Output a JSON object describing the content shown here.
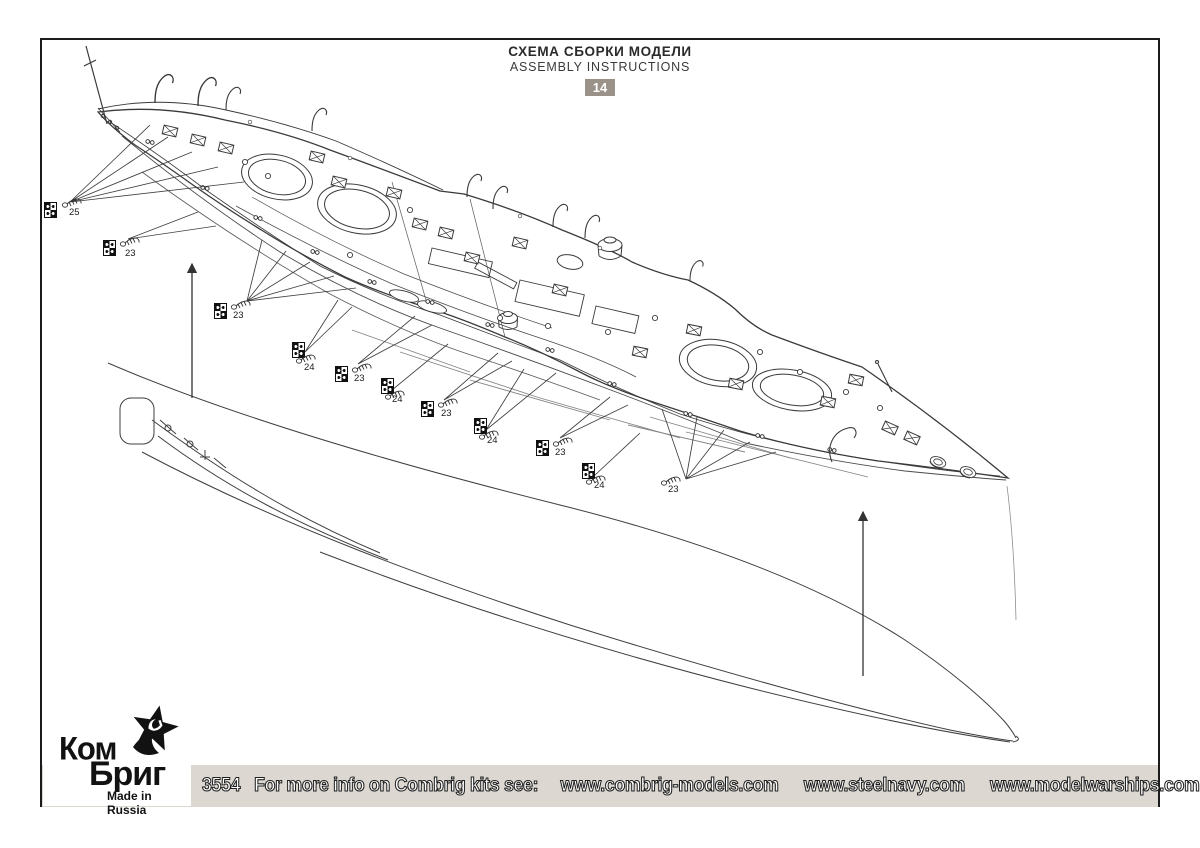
{
  "header": {
    "title_ru": "СХЕМА СБОРКИ МОДЕЛИ",
    "title_en": "ASSEMBLY INSTRUCTIONS",
    "sheet_number": "14"
  },
  "callouts": [
    {
      "label": "25",
      "marker": {
        "x": 44,
        "y": 202
      },
      "part": {
        "x": 62,
        "y": 196
      },
      "label_pos": {
        "x": 69,
        "y": 208
      }
    },
    {
      "label": "23",
      "marker": {
        "x": 103,
        "y": 240
      },
      "part": {
        "x": 120,
        "y": 235
      },
      "label_pos": {
        "x": 125,
        "y": 249
      }
    },
    {
      "label": "23",
      "marker": {
        "x": 214,
        "y": 303
      },
      "part": {
        "x": 231,
        "y": 298
      },
      "label_pos": {
        "x": 233,
        "y": 311
      }
    },
    {
      "label": "24",
      "marker": {
        "x": 292,
        "y": 342
      },
      "part": {
        "x": 296,
        "y": 352
      },
      "label_pos": {
        "x": 304,
        "y": 363
      }
    },
    {
      "label": "23",
      "marker": {
        "x": 335,
        "y": 366
      },
      "part": {
        "x": 352,
        "y": 361
      },
      "label_pos": {
        "x": 354,
        "y": 374
      }
    },
    {
      "label": "24",
      "marker": {
        "x": 381,
        "y": 378
      },
      "part": {
        "x": 385,
        "y": 388
      },
      "label_pos": {
        "x": 392,
        "y": 395
      }
    },
    {
      "label": "23",
      "marker": {
        "x": 421,
        "y": 401
      },
      "part": {
        "x": 438,
        "y": 396
      },
      "label_pos": {
        "x": 441,
        "y": 409
      }
    },
    {
      "label": "24",
      "marker": {
        "x": 474,
        "y": 418
      },
      "part": {
        "x": 479,
        "y": 428
      },
      "label_pos": {
        "x": 487,
        "y": 436
      }
    },
    {
      "label": "23",
      "marker": {
        "x": 536,
        "y": 440
      },
      "part": {
        "x": 553,
        "y": 435
      },
      "label_pos": {
        "x": 555,
        "y": 448
      }
    },
    {
      "label": "24",
      "marker": {
        "x": 582,
        "y": 463
      },
      "part": {
        "x": 586,
        "y": 473
      },
      "label_pos": {
        "x": 594,
        "y": 481
      }
    },
    {
      "label": "23",
      "marker": null,
      "part": {
        "x": 661,
        "y": 474
      },
      "label_pos": {
        "x": 668,
        "y": 485
      }
    }
  ],
  "footer": {
    "kit_number": "3554",
    "info_text": "For more info on Combrig kits see:",
    "urls": [
      "www.combrig-models.com",
      "www.steelnavy.com",
      "www.modelwarships.com"
    ],
    "logo": {
      "line1": "Ком",
      "line2": "Бриг",
      "tagline": "Made in Russia"
    }
  },
  "colors": {
    "sheet_badge_bg": "#9a9189",
    "footer_bar_bg": "#dcd8d1",
    "ink": "#3a3a3a",
    "frame": "#1b1b1b"
  }
}
